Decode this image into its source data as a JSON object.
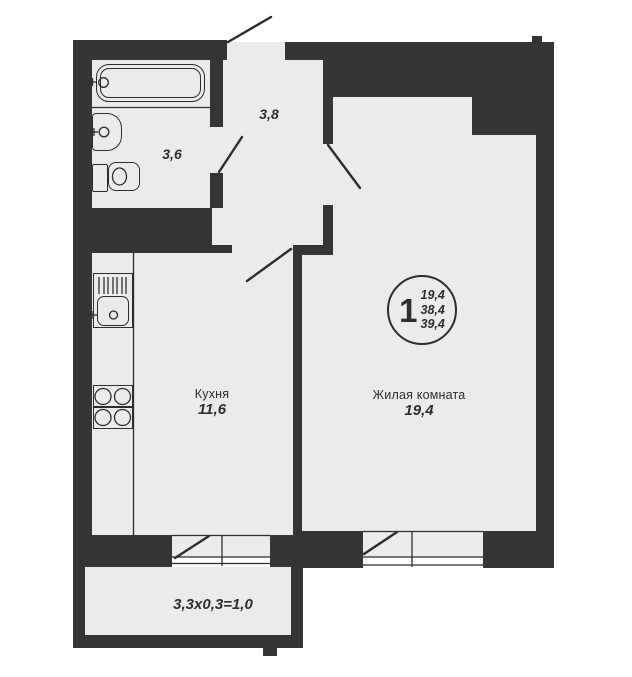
{
  "colors": {
    "wall": "#343537",
    "floor": "#eaebeb",
    "line": "#2d2d2d",
    "text": "#2e2e2e",
    "bg": "#ffffff"
  },
  "badge": {
    "room_count": "1",
    "areas": [
      "19,4",
      "38,4",
      "39,4"
    ]
  },
  "rooms": {
    "hallway": {
      "area": "3,8"
    },
    "bathroom": {
      "area": "3,6"
    },
    "kitchen": {
      "name": "Кухня",
      "area": "11,6"
    },
    "living": {
      "name": "Жилая комната",
      "area": "19,4"
    },
    "balcony": {
      "dimensions": "3,3x0,3=1,0"
    }
  },
  "icons": {
    "bathtub": "bathtub-icon",
    "sink": "sink-icon",
    "toilet": "toilet-icon",
    "kitchen_sink": "kitchen-sink-icon",
    "stove": "stove-icon"
  }
}
